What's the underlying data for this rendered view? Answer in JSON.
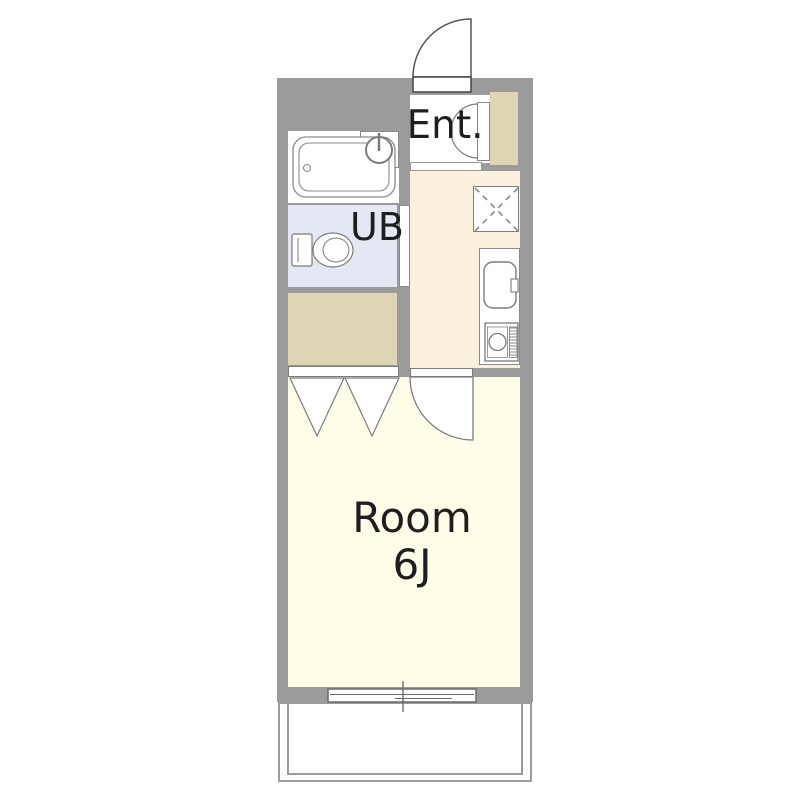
{
  "floorplan": {
    "labels": {
      "entrance": "Ent.",
      "unit_bath": "UB",
      "room_name": "Room",
      "room_size": "6J"
    },
    "rooms": [
      {
        "name": "entrance",
        "label": "Ent."
      },
      {
        "name": "unit-bath",
        "label": "UB"
      },
      {
        "name": "main-room",
        "label": "Room 6J"
      }
    ],
    "colors": {
      "wall": "#9b9b9b",
      "room-floor": "#fffde8",
      "kitchen-floor": "#fbf0dc",
      "closet": "#ded5b4",
      "bath": "#e3e8f3",
      "line": "#7b7b7b"
    }
  }
}
